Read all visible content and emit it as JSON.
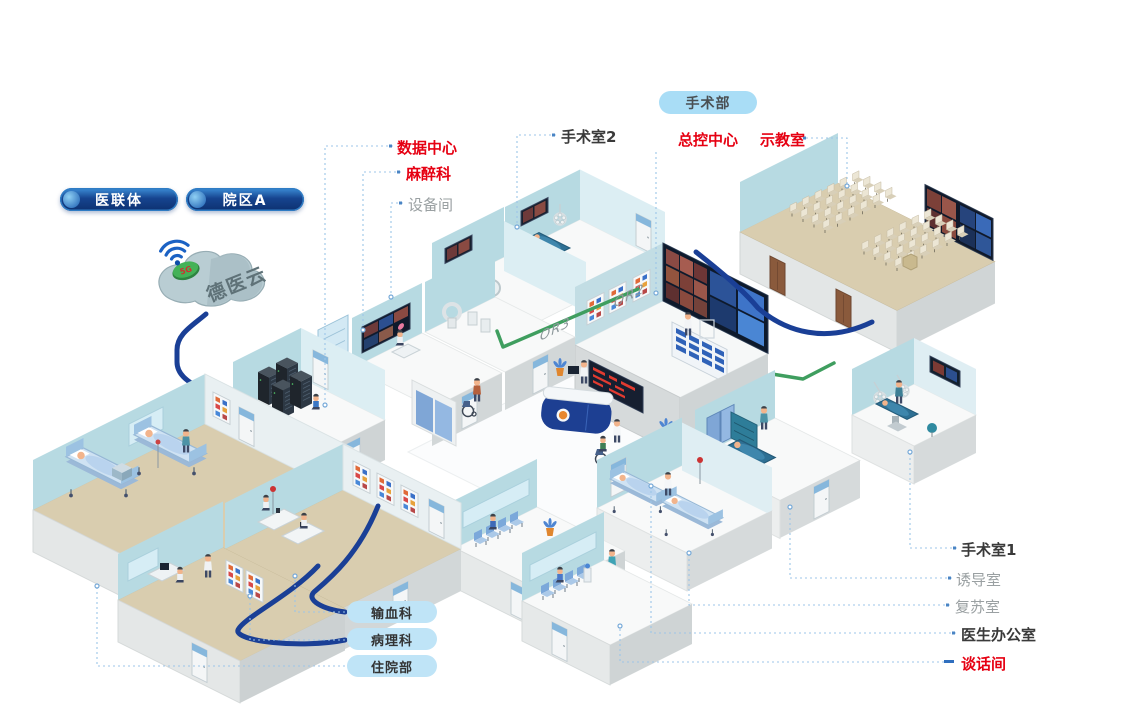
{
  "cloud": {
    "platform_name": "德医云",
    "badge": "5G"
  },
  "top_buttons": [
    {
      "label": "医联体"
    },
    {
      "label": "院区A"
    }
  ],
  "area_pill": {
    "label": "手术部"
  },
  "room_labels": {
    "data_center": {
      "text": "数据中心",
      "emphasis": "red"
    },
    "anesthesia": {
      "text": "麻醉科",
      "emphasis": "red"
    },
    "equipment_room": {
      "text": "设备间",
      "emphasis": "gray"
    },
    "operating_room_2": {
      "text": "手术室2",
      "emphasis": "dark"
    },
    "master_control": {
      "text": "总控中心",
      "emphasis": "red"
    },
    "demo_classroom": {
      "text": "示教室",
      "emphasis": "red"
    },
    "operating_room_1": {
      "text": "手术室1",
      "emphasis": "dark"
    },
    "induction_room": {
      "text": "诱导室",
      "emphasis": "gray"
    },
    "recovery_room": {
      "text": "复苏室",
      "emphasis": "gray"
    },
    "doctor_office": {
      "text": "医生办公室",
      "emphasis": "dark"
    },
    "talk_room": {
      "text": "谈话间",
      "emphasis": "red"
    }
  },
  "bottom_pills": [
    {
      "label": "输血科"
    },
    {
      "label": "病理科"
    },
    {
      "label": "住院部"
    }
  ],
  "wall_marks": {
    "or2": "OR2",
    "or3": "OR3"
  },
  "colors": {
    "label_red": "#e60012",
    "cable_blue": "#1a3f96",
    "cable_green": "#3f9e5f",
    "leader": "#9cc5e8",
    "pill_dark": "#10347c",
    "pill_light_top": "#a9ddf6",
    "pill_light_bottom": "#bfe4f7",
    "wall_teal": "#b7dae2",
    "floor_tan": "#d9cdaf"
  }
}
